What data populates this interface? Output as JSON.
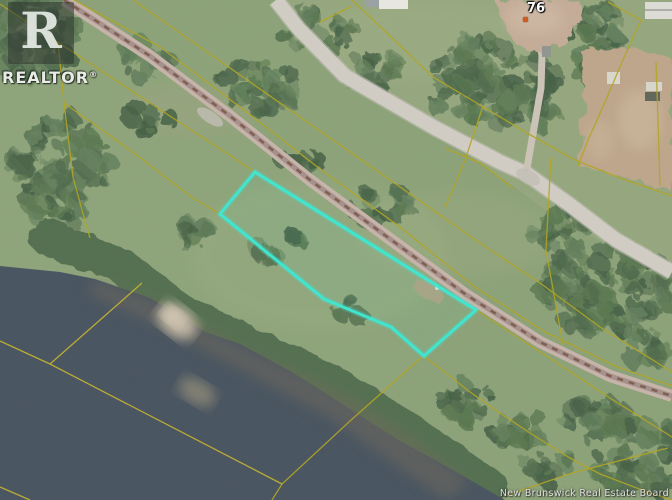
{
  "branding": {
    "logo_letter": "R",
    "logo_text": "REALTOR",
    "registered_mark": "®"
  },
  "annotations": {
    "house_number": "76"
  },
  "watermark": {
    "text": "New Brunswick Real Estate Board"
  },
  "colors": {
    "grass": "#8ba177",
    "grass_light": "#9cab83",
    "grass_sw": "#90a67c",
    "shrub": "#4e6a4c",
    "water": "#46525e",
    "shore_shallow": "#6e685a",
    "sand": "#c7bba7",
    "railway": "#c7b4ab",
    "railway_center": "#a5908a",
    "railway_ties": "#7e5a4e",
    "road": "#d1cdc4",
    "road_edge": "#c2beb5",
    "driveway": "#cbc3b6",
    "dirt": "#c4ab97",
    "dirt_field": "#bda58a",
    "cadastral": "#b1a41f",
    "cadastral_water": "#c6b42c",
    "boundary": "#3ae8d2",
    "marker": "#cf5c1d"
  },
  "map": {
    "width": 672,
    "height": 500,
    "tree_palette": [
      "#4e6a4c",
      "#59774f",
      "#445f44",
      "#63805c"
    ],
    "regions": {
      "ne_of_road": [
        [
          276,
          0
        ],
        [
          672,
          0
        ],
        [
          672,
          271
        ],
        [
          616,
          249
        ],
        [
          560,
          221
        ],
        [
          513,
          186
        ],
        [
          432,
          130
        ],
        [
          345,
          76
        ],
        [
          298,
          28
        ]
      ],
      "sw_of_rail": [
        [
          64,
          0
        ],
        [
          150,
          56
        ],
        [
          230,
          116
        ],
        [
          310,
          178
        ],
        [
          390,
          237
        ],
        [
          465,
          294
        ],
        [
          476,
          310
        ],
        [
          424,
          356
        ],
        [
          350,
          421
        ],
        [
          282,
          484
        ],
        [
          272,
          500
        ],
        [
          0,
          500
        ],
        [
          0,
          4
        ]
      ]
    },
    "tonal": [
      {
        "cx": 320,
        "cy": 255,
        "rx": 130,
        "ry": 75,
        "c": "#9cb083",
        "o": 0.3
      },
      {
        "cx": 455,
        "cy": 235,
        "rx": 100,
        "ry": 45,
        "c": "#a3ad85",
        "o": 0.25
      },
      {
        "cx": 430,
        "cy": 40,
        "rx": 120,
        "ry": 40,
        "c": "#a4b288",
        "o": 0.3
      },
      {
        "cx": 190,
        "cy": 110,
        "rx": 70,
        "ry": 25,
        "c": "#b0a58c",
        "o": 0.2
      }
    ],
    "tree_clusters": [
      [
        32,
        35,
        46,
        46
      ],
      [
        62,
        170,
        48,
        58
      ],
      [
        145,
        60,
        26,
        18
      ],
      [
        150,
        118,
        20,
        14
      ],
      [
        320,
        35,
        36,
        26
      ],
      [
        372,
        72,
        28,
        22
      ],
      [
        255,
        85,
        40,
        26
      ],
      [
        300,
        160,
        20,
        12
      ],
      [
        380,
        205,
        32,
        16
      ],
      [
        490,
        82,
        66,
        44
      ],
      [
        530,
        108,
        28,
        22
      ],
      [
        595,
        45,
        30,
        44
      ],
      [
        560,
        228,
        30,
        22
      ],
      [
        608,
        288,
        66,
        46
      ],
      [
        648,
        348,
        22,
        16
      ],
      [
        190,
        238,
        22,
        14
      ],
      [
        262,
        252,
        15,
        10
      ],
      [
        305,
        235,
        12,
        9
      ],
      [
        352,
        310,
        16,
        11
      ],
      [
        465,
        400,
        28,
        20
      ],
      [
        515,
        432,
        30,
        22
      ],
      [
        548,
        465,
        26,
        16
      ],
      [
        595,
        420,
        34,
        22
      ],
      [
        640,
        458,
        52,
        36
      ]
    ],
    "shrub_band": {
      "points": [
        [
          48,
          238
        ],
        [
          120,
          265
        ],
        [
          185,
          315
        ],
        [
          250,
          345
        ],
        [
          310,
          372
        ],
        [
          360,
          400
        ],
        [
          405,
          428
        ],
        [
          445,
          456
        ],
        [
          490,
          487
        ]
      ],
      "width": 36
    },
    "water": {
      "points": [
        [
          0,
          266
        ],
        [
          60,
          272
        ],
        [
          95,
          279
        ],
        [
          150,
          298
        ],
        [
          205,
          332
        ],
        [
          240,
          344
        ],
        [
          290,
          371
        ],
        [
          330,
          396
        ],
        [
          367,
          420
        ],
        [
          400,
          441
        ],
        [
          437,
          461
        ],
        [
          470,
          480
        ],
        [
          505,
          500
        ],
        [
          0,
          500
        ]
      ]
    },
    "shallow": {
      "points": [
        [
          95,
          280
        ],
        [
          160,
          303
        ],
        [
          240,
          346
        ],
        [
          300,
          373
        ],
        [
          360,
          402
        ],
        [
          410,
          434
        ],
        [
          445,
          462
        ],
        [
          470,
          482
        ],
        [
          445,
          500
        ],
        [
          400,
          468
        ],
        [
          330,
          418
        ],
        [
          245,
          372
        ],
        [
          150,
          322
        ],
        [
          88,
          293
        ]
      ]
    },
    "sandbar": [
      {
        "cx": 177,
        "cy": 321,
        "rx": 22,
        "ry": 15,
        "rot": 38,
        "c": "#c7bba7",
        "o": 0.95
      },
      {
        "cx": 173,
        "cy": 316,
        "rx": 12,
        "ry": 8,
        "rot": 38,
        "c": "#d4c9b5",
        "o": 0.9
      },
      {
        "cx": 197,
        "cy": 392,
        "rx": 20,
        "ry": 12,
        "rot": 30,
        "c": "#9f947c",
        "o": 0.65
      }
    ],
    "railway": {
      "points": [
        [
          64,
          0
        ],
        [
          150,
          56
        ],
        [
          230,
          116
        ],
        [
          310,
          180
        ],
        [
          390,
          239
        ],
        [
          465,
          294
        ],
        [
          540,
          342
        ],
        [
          610,
          376
        ],
        [
          672,
          396
        ]
      ]
    },
    "road": {
      "points": [
        [
          276,
          0
        ],
        [
          298,
          28
        ],
        [
          345,
          76
        ],
        [
          435,
          128
        ],
        [
          500,
          162
        ],
        [
          527,
          174
        ],
        [
          570,
          205
        ],
        [
          616,
          240
        ],
        [
          672,
          272
        ]
      ]
    },
    "driveway": {
      "points": [
        [
          527,
          168
        ],
        [
          534,
          128
        ],
        [
          541,
          88
        ],
        [
          542,
          55
        ],
        [
          538,
          36
        ]
      ]
    },
    "gravel_patches": [
      {
        "cx": 210,
        "cy": 117,
        "rx": 15,
        "ry": 6,
        "rot": 33
      },
      {
        "cx": 528,
        "cy": 177,
        "rx": 13,
        "ry": 7,
        "rot": 28
      }
    ],
    "dirt_patches": {
      "house_yard": [
        [
          497,
          0
        ],
        [
          578,
          0
        ],
        [
          582,
          20
        ],
        [
          568,
          40
        ],
        [
          545,
          54
        ],
        [
          518,
          46
        ],
        [
          504,
          28
        ],
        [
          499,
          12
        ]
      ],
      "field": [
        [
          582,
          52
        ],
        [
          630,
          46
        ],
        [
          672,
          60
        ],
        [
          672,
          192
        ],
        [
          618,
          176
        ],
        [
          578,
          166
        ],
        [
          584,
          108
        ]
      ],
      "field_light": [
        {
          "cx": 640,
          "cy": 120,
          "rx": 22,
          "ry": 30,
          "c": "#cbb79c",
          "o": 0.7
        },
        {
          "cx": 600,
          "cy": 140,
          "rx": 14,
          "ry": 20,
          "c": "#cbb79c",
          "o": 0.5
        },
        {
          "cx": 535,
          "cy": 18,
          "rx": 28,
          "ry": 16,
          "c": "#cfb9a4",
          "o": 0.8
        }
      ],
      "clearing": {
        "cx": 428,
        "cy": 290,
        "rx": 15,
        "ry": 8,
        "rot": 20,
        "c": "#b2a183",
        "o": 0.85
      },
      "clearing_speck": {
        "cx": 437,
        "cy": 288,
        "r": 2,
        "c": "#e8e4da"
      }
    },
    "buildings": [
      {
        "x": 366,
        "y": 0,
        "w": 13,
        "h": 7,
        "c": "#9aa0a2"
      },
      {
        "x": 379,
        "y": 0,
        "w": 29,
        "h": 9,
        "c": "#e9e7e1"
      },
      {
        "x": 645,
        "y": 2,
        "w": 27,
        "h": 17,
        "c": "#dddcd6"
      },
      {
        "x": 645,
        "y": 9,
        "w": 27,
        "h": 2,
        "c": "#aeaea8"
      },
      {
        "x": 646,
        "y": 82,
        "w": 16,
        "h": 9,
        "c": "#d8d5cc"
      },
      {
        "x": 645,
        "y": 92,
        "w": 15,
        "h": 9,
        "c": "#5f6458"
      },
      {
        "x": 607,
        "y": 72,
        "w": 13,
        "h": 12,
        "c": "#dad7ce"
      },
      {
        "x": 542,
        "y": 46,
        "w": 9,
        "h": 11,
        "c": "#8f948e"
      }
    ],
    "cadastral_lines": [
      {
        "name": "rail-ne-edge-line",
        "points": [
          [
            74,
            0
          ],
          [
            160,
            47
          ],
          [
            240,
            107
          ],
          [
            320,
            169
          ],
          [
            400,
            227
          ],
          [
            472,
            285
          ],
          [
            545,
            332
          ],
          [
            615,
            366
          ],
          [
            672,
            386
          ]
        ]
      },
      {
        "name": "mid-parallel-line",
        "points": [
          [
            133,
            0
          ],
          [
            190,
            40
          ],
          [
            300,
            117
          ],
          [
            393,
            182
          ],
          [
            480,
            243
          ],
          [
            540,
            283
          ],
          [
            600,
            327
          ],
          [
            672,
            372
          ]
        ]
      },
      {
        "name": "rail-sw-edge-upper",
        "points": [
          [
            0,
            4
          ],
          [
            62,
            45
          ],
          [
            150,
            103
          ],
          [
            237,
            160
          ],
          [
            255,
            172
          ]
        ]
      },
      {
        "name": "rail-sw-edge-lower",
        "points": [
          [
            476,
            310
          ],
          [
            545,
            355
          ],
          [
            610,
            398
          ],
          [
            672,
            437
          ]
        ]
      },
      {
        "name": "sw-lot-line",
        "points": [
          [
            64,
            103
          ],
          [
            130,
            150
          ],
          [
            190,
            196
          ],
          [
            220,
            214
          ]
        ]
      },
      {
        "name": "left-steep-line",
        "points": [
          [
            58,
            42
          ],
          [
            64,
            103
          ],
          [
            73,
            177
          ],
          [
            82,
            210
          ],
          [
            90,
            238
          ]
        ]
      },
      {
        "name": "shore-parallel-line",
        "points": [
          [
            424,
            356
          ],
          [
            470,
            392
          ],
          [
            500,
            413
          ],
          [
            530,
            433
          ],
          [
            570,
            458
          ],
          [
            600,
            474
          ],
          [
            650,
            493
          ],
          [
            672,
            500
          ]
        ]
      },
      {
        "name": "shore-perpendicular-line",
        "points": [
          [
            423,
            356
          ],
          [
            350,
            421
          ],
          [
            282,
            484
          ],
          [
            272,
            500
          ]
        ]
      },
      {
        "name": "water-lot-line-a",
        "points": [
          [
            0,
            341
          ],
          [
            50,
            364
          ],
          [
            282,
            484
          ]
        ],
        "water": true
      },
      {
        "name": "water-lot-line-b",
        "points": [
          [
            142,
            283
          ],
          [
            50,
            364
          ]
        ],
        "water": true
      },
      {
        "name": "rising-rear-lot-line",
        "points": [
          [
            505,
            496
          ],
          [
            572,
            473
          ],
          [
            668,
            448
          ]
        ]
      },
      {
        "name": "water-corner-line",
        "points": [
          [
            0,
            487
          ],
          [
            30,
            500
          ]
        ],
        "water": true
      },
      {
        "name": "road-ne-parallel-line",
        "points": [
          [
            352,
            0
          ],
          [
            433,
            77
          ],
          [
            527,
            133
          ],
          [
            575,
            160
          ],
          [
            620,
            178
          ],
          [
            672,
            196
          ]
        ]
      },
      {
        "name": "road-sw-edge-line",
        "points": [
          [
            445,
            148
          ],
          [
            480,
            163
          ],
          [
            513,
            188
          ]
        ]
      },
      {
        "name": "field-west-line",
        "points": [
          [
            608,
            2
          ],
          [
            641,
            20
          ],
          [
            622,
            62
          ],
          [
            606,
            100
          ],
          [
            588,
            140
          ],
          [
            578,
            166
          ]
        ]
      },
      {
        "name": "field-east-line",
        "points": [
          [
            660,
            186
          ],
          [
            658,
            120
          ],
          [
            656,
            62
          ]
        ]
      },
      {
        "name": "top-spur-line",
        "points": [
          [
            352,
            6
          ],
          [
            320,
            22
          ]
        ]
      },
      {
        "name": "cross-lot-line-a",
        "points": [
          [
            483,
            106
          ],
          [
            465,
            160
          ],
          [
            445,
            208
          ]
        ]
      },
      {
        "name": "cross-lot-line-b",
        "points": [
          [
            551,
            157
          ],
          [
            546,
            250
          ],
          [
            563,
            345
          ]
        ]
      }
    ],
    "boundary": {
      "points": [
        [
          255,
          172
        ],
        [
          220,
          214
        ],
        [
          324,
          299
        ],
        [
          391,
          327
        ],
        [
          424,
          356
        ],
        [
          476,
          310
        ]
      ]
    },
    "marker": {
      "x": 525,
      "y": 19
    }
  }
}
